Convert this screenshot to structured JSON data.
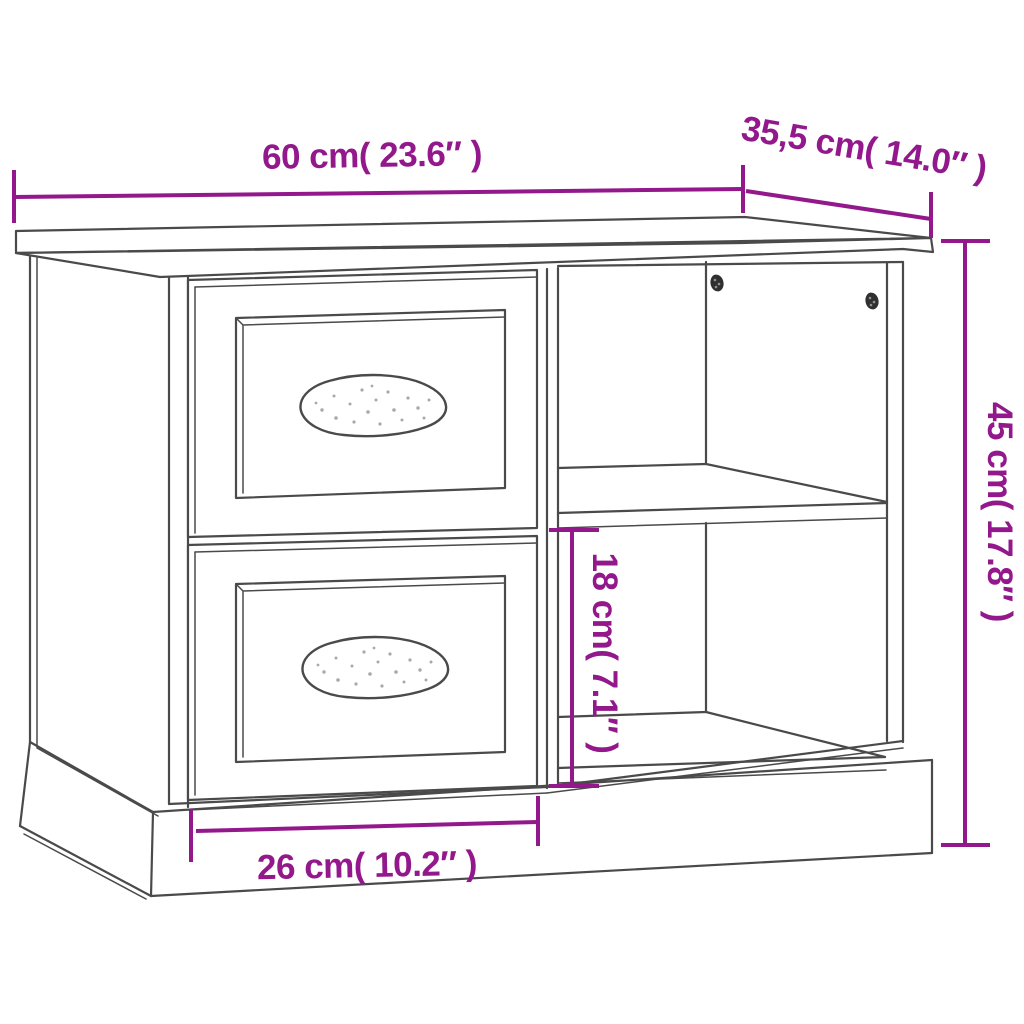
{
  "diagram": {
    "dimensions": {
      "width": {
        "label": "60 cm( 23.6″ )"
      },
      "depth": {
        "label": "35,5 cm( 14.0″ )"
      },
      "height": {
        "label": "45 cm( 17.8″ )"
      },
      "inner_height": {
        "label": "18 cm( 7.1″ )"
      },
      "drawer_width": {
        "label": "26 cm( 10.2″ )"
      }
    },
    "colors": {
      "dimension_accent": "#93188C",
      "outline": "#4A4A4A",
      "background": "#FFFFFF"
    }
  }
}
